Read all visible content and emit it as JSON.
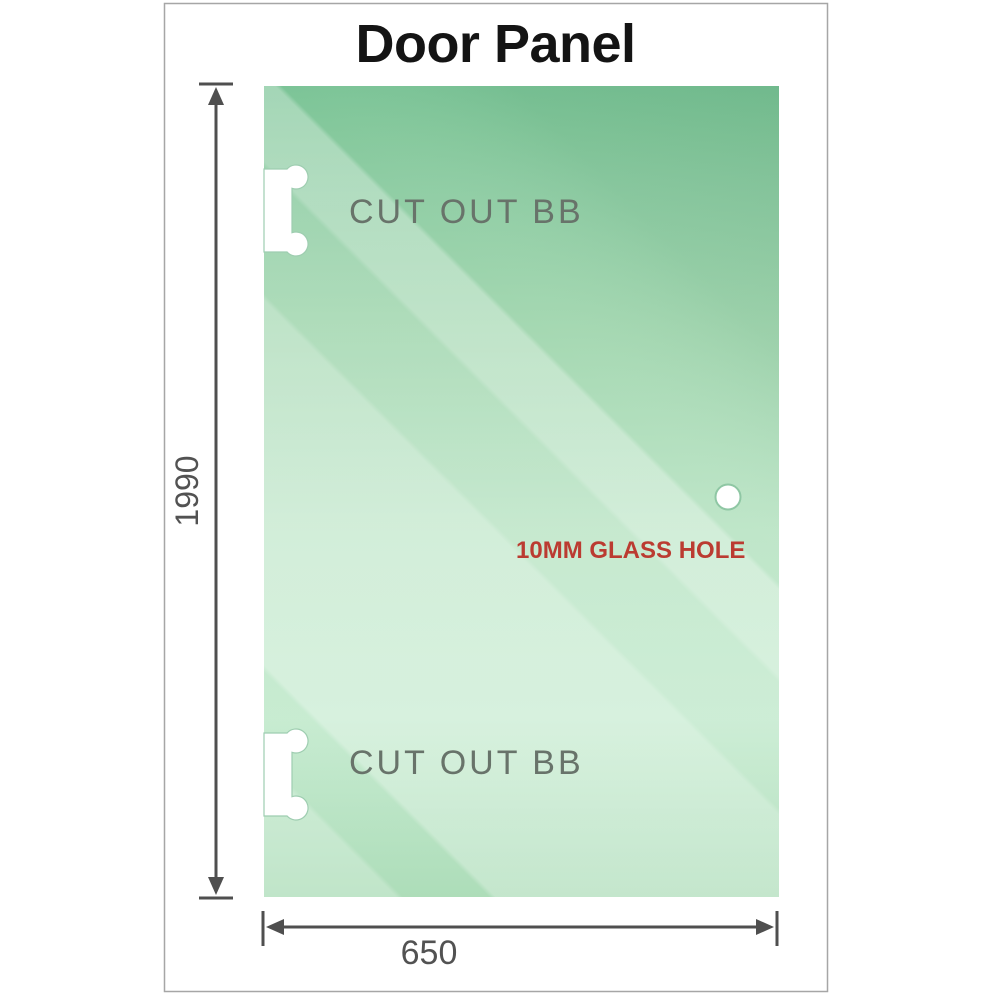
{
  "title": "Door Panel",
  "panel": {
    "cutouts": [
      {
        "label": "CUT OUT BB"
      },
      {
        "label": "CUT OUT BB"
      }
    ],
    "hole": {
      "label": "10MM GLASS HOLE"
    }
  },
  "dimensions": {
    "height": {
      "value": "1990"
    },
    "width": {
      "value": "650"
    }
  },
  "icons": {
    "arrows": [
      "arrow-up-icon",
      "arrow-down-icon",
      "arrow-left-icon",
      "arrow-right-icon"
    ]
  },
  "colors": {
    "glass_green_dark": "#7cc497",
    "glass_green_mid": "#a5d8b2",
    "glass_green_light": "#c9ecd3",
    "dimension_gray": "#4f4f4f",
    "label_gray": "#68736a",
    "hole_label_red": "#bb3b31",
    "title_black": "#141414",
    "page_border_gray": "#a6a6a6"
  }
}
